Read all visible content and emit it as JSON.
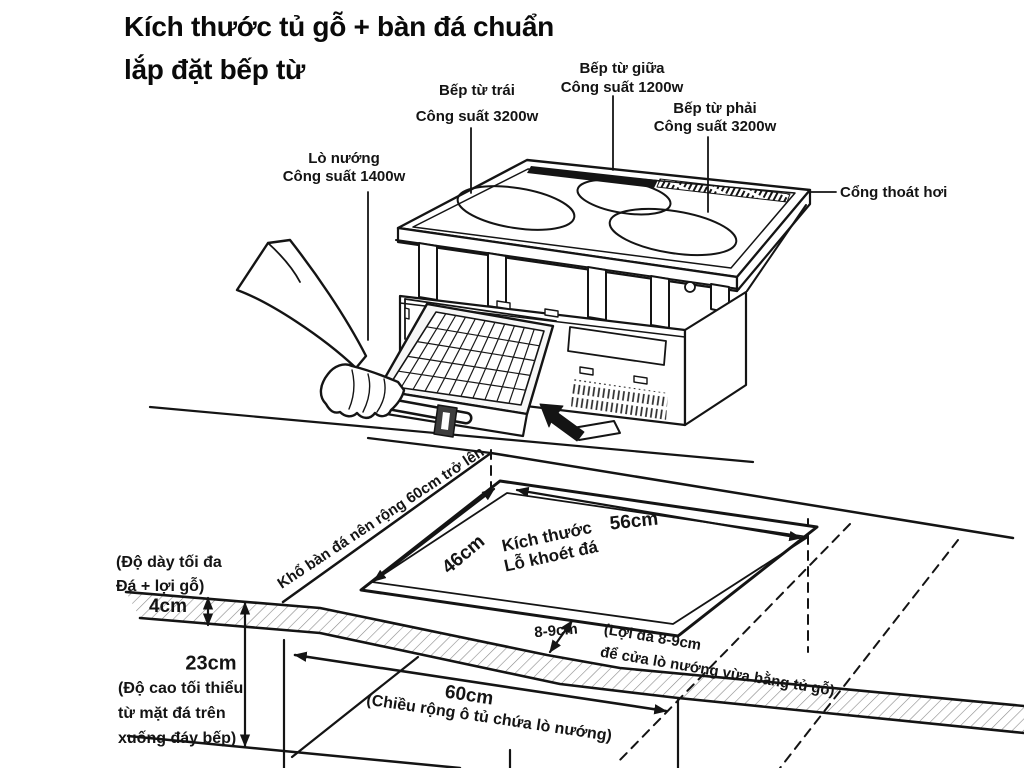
{
  "title": {
    "line1": "Kích thước tủ gỗ + bàn đá chuẩn",
    "line2": "lắp đặt bếp từ"
  },
  "callouts": {
    "left_burner": {
      "name": "Bếp từ trái",
      "power": "Công suất 3200w"
    },
    "middle_burner": {
      "name": "Bếp từ giữa",
      "power": "Công suất 1200w"
    },
    "right_burner": {
      "name": "Bếp từ phải",
      "power": "Công suất 3200w"
    },
    "oven": {
      "name": "Lò nướng",
      "power": "Công suất 1400w"
    },
    "vent": {
      "name": "Cổng thoát hơi"
    }
  },
  "dimensions": {
    "hole_depth": "46cm",
    "hole_width": "56cm",
    "hole_label_line1": "Kích thước",
    "hole_label_line2": "Lỗ khoét đá",
    "stone_width_note": "Khổ bàn đá nên rộng 60cm trở lên",
    "edge_gap": "8-9cm",
    "edge_gap_note_line1": "(Lợi đá 8-9cm",
    "edge_gap_note_line2": "để cửa lò nướng vừa bằng tủ gỗ)",
    "stone_thickness": "4cm",
    "stone_thickness_note_line1": "(Độ dày tối đa",
    "stone_thickness_note_line2": "Đá + lợi gỗ)",
    "cabinet_height": "23cm",
    "cabinet_height_note_line1": "(Độ cao tối thiểu",
    "cabinet_height_note_line2": "từ mặt đá trên",
    "cabinet_height_note_line3": "xuống đáy bếp)",
    "cabinet_width": "60cm",
    "cabinet_width_note": "(Chiều rộng ô tủ chứa lò nướng)"
  },
  "colors": {
    "ink": "#141414",
    "background": "#ffffff"
  }
}
